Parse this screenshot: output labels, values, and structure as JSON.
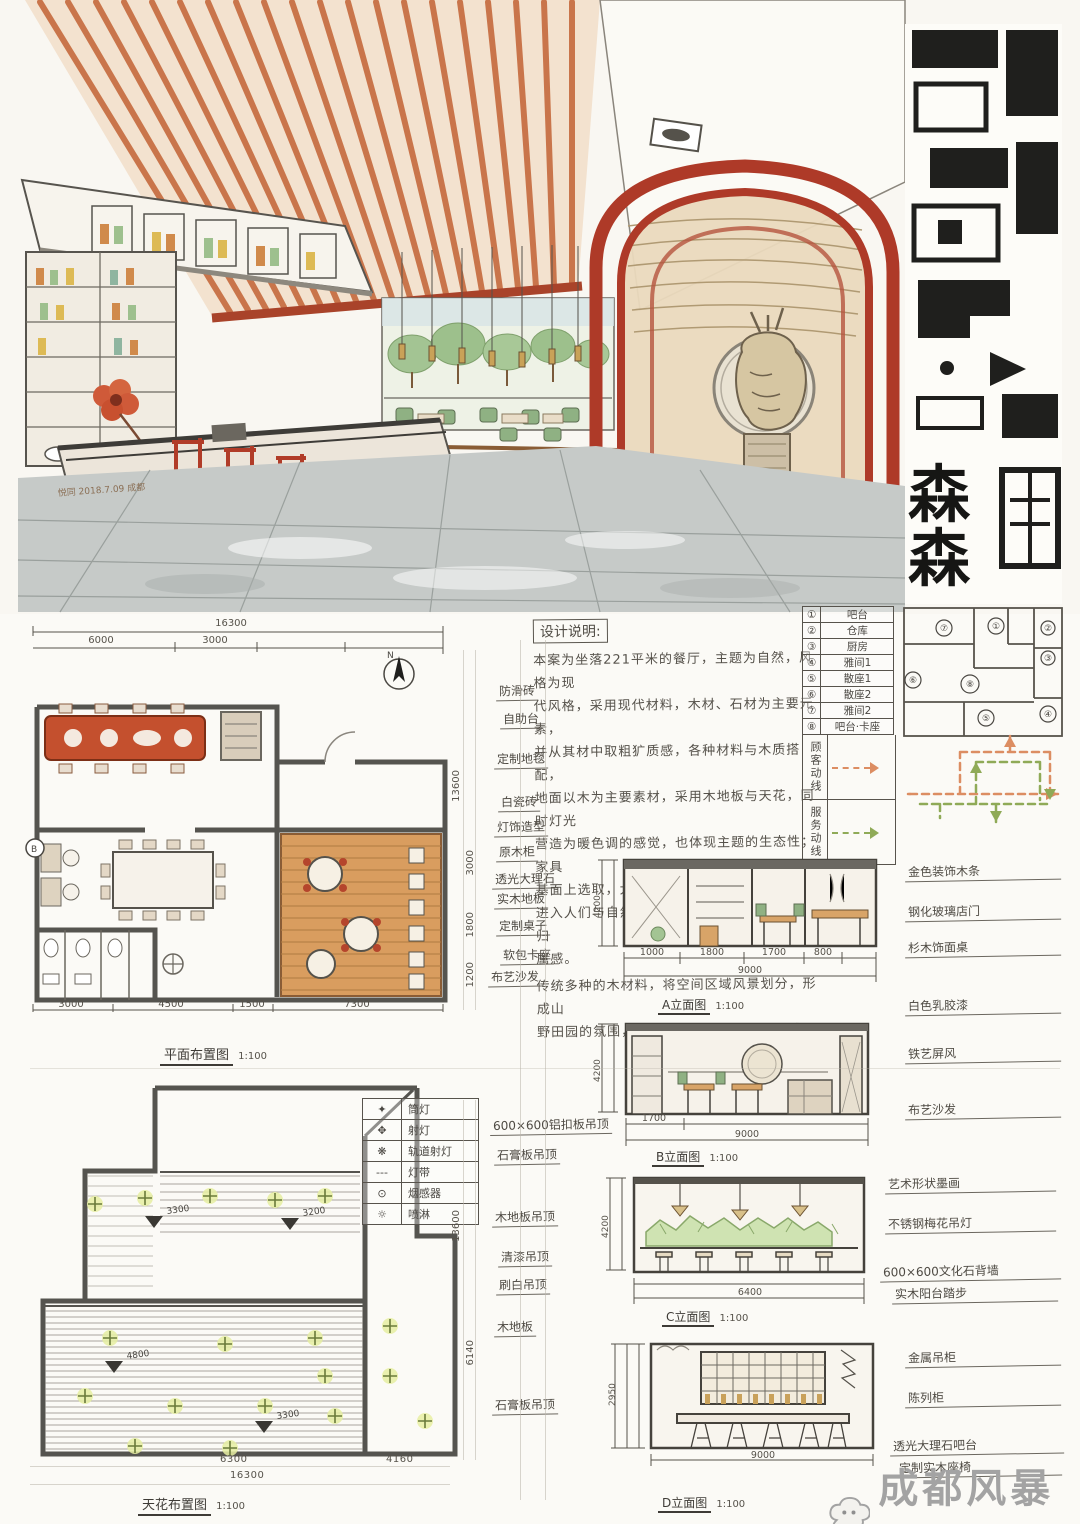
{
  "perspective": {
    "signature": "悦同 2018.7.09 成都",
    "banner_chars": [
      "森",
      "森"
    ]
  },
  "notes": {
    "title": "设计说明:",
    "lines": [
      "本案为坐落221平米的餐厅，主题为自然，风格为现",
      "代风格，采用现代材料，木材、石材为主要元素，",
      "并从其材中取粗犷质感，各种材料与木质搭配，",
      "地面以木为主要素材，采用木地板与天花，同时灯光",
      "营造为暖色调的感觉，也体现主题的生态性；家具",
      "基面上选取，大量的木材与金属家具，加强让",
      "进入人们与自然亲近，让整个餐厅有温馨感与归",
      "属感。",
      "传统多种的木材料，将空间区域风景划分，形成山",
      "野田园的氛围，让每个空间有自然的归属感。"
    ]
  },
  "function_table": {
    "rows": [
      {
        "no": "①",
        "label": "吧台"
      },
      {
        "no": "②",
        "label": "仓库"
      },
      {
        "no": "③",
        "label": "厨房"
      },
      {
        "no": "④",
        "label": "雅间1"
      },
      {
        "no": "⑤",
        "label": "散座1"
      },
      {
        "no": "⑥",
        "label": "散座2"
      },
      {
        "no": "⑦",
        "label": "雅间2"
      },
      {
        "no": "⑧",
        "label": "吧台·卡座"
      }
    ],
    "legend": [
      {
        "label": "顾客动线",
        "color": "#dc8d62"
      },
      {
        "label": "服务动线",
        "color": "#8faa57"
      }
    ],
    "bubble_numbers": [
      "①",
      "②",
      "③",
      "④",
      "⑤",
      "⑥",
      "⑦",
      "⑧"
    ]
  },
  "floor_plan": {
    "title": "平面布置图",
    "title_scale": "1:100",
    "dims_top": {
      "total": "16300",
      "seg1": "6000",
      "seg2": "3000"
    },
    "dims_bottom": {
      "s1": "3000",
      "s2": "4500",
      "s3": "1500",
      "s4": "7300",
      "r2a": "6300",
      "r2b": "4160",
      "total": "16300"
    },
    "side_dim_main": "13600",
    "side_dims_small": [
      "3000",
      "1800",
      "1200"
    ],
    "north_label": "N",
    "section_marker": "B",
    "labels": [
      "防滑砖",
      "自助台",
      "定制地毯",
      "白瓷砖",
      "灯饰造型",
      "原木柜",
      "透光大理石",
      "实木地板",
      "定制桌子",
      "软包卡座",
      "布艺沙发"
    ]
  },
  "ceiling_plan": {
    "title": "天花布置图",
    "title_scale": "1:100",
    "legend": [
      {
        "label": "筒灯"
      },
      {
        "label": "射灯"
      },
      {
        "label": "轨道射灯"
      },
      {
        "label": "灯带"
      },
      {
        "label": "烟感器"
      },
      {
        "label": "喷淋"
      }
    ],
    "level_marks": [
      "3300",
      "3200",
      "4800",
      "3300"
    ],
    "dims_bottom": {
      "r1a": "6300",
      "r1b": "4160",
      "total": "16300"
    },
    "side_dim_main": "13600",
    "side_dim_small": "6140",
    "labels": [
      "600×600铝扣板吊顶",
      "石膏板吊顶",
      "木地板吊顶",
      "清漆吊顶",
      "刷白吊顶",
      "木地板",
      "石膏板吊顶"
    ]
  },
  "elevations": [
    {
      "title": "A立面图",
      "scale": "1:100",
      "height": "4200",
      "s1": "1000",
      "s2": "1800",
      "s3": "1700",
      "s4": "800",
      "total": "9000",
      "labels": [
        "金色装饰木条",
        "钢化玻璃店门",
        "杉木饰面桌"
      ]
    },
    {
      "title": "B立面图",
      "scale": "1:100",
      "height": "4200",
      "s1": "1700",
      "total": "9000",
      "labels": [
        "白色乳胶漆",
        "铁艺屏风",
        "布艺沙发"
      ]
    },
    {
      "title": "C立面图",
      "scale": "1:100",
      "height": "4200",
      "total": "6400",
      "labels": [
        "艺术形状墨画",
        "不锈钢梅花吊灯",
        "600×600文化石背墙",
        "实木阳台踏步"
      ]
    },
    {
      "title": "D立面图",
      "scale": "1:100",
      "height": "2950",
      "total": "9000",
      "labels": [
        "金属吊柜",
        "陈列柜",
        "透光大理石吧台",
        "定制实木座椅"
      ]
    }
  ],
  "watermark": {
    "text": "成都风暴手绘"
  }
}
